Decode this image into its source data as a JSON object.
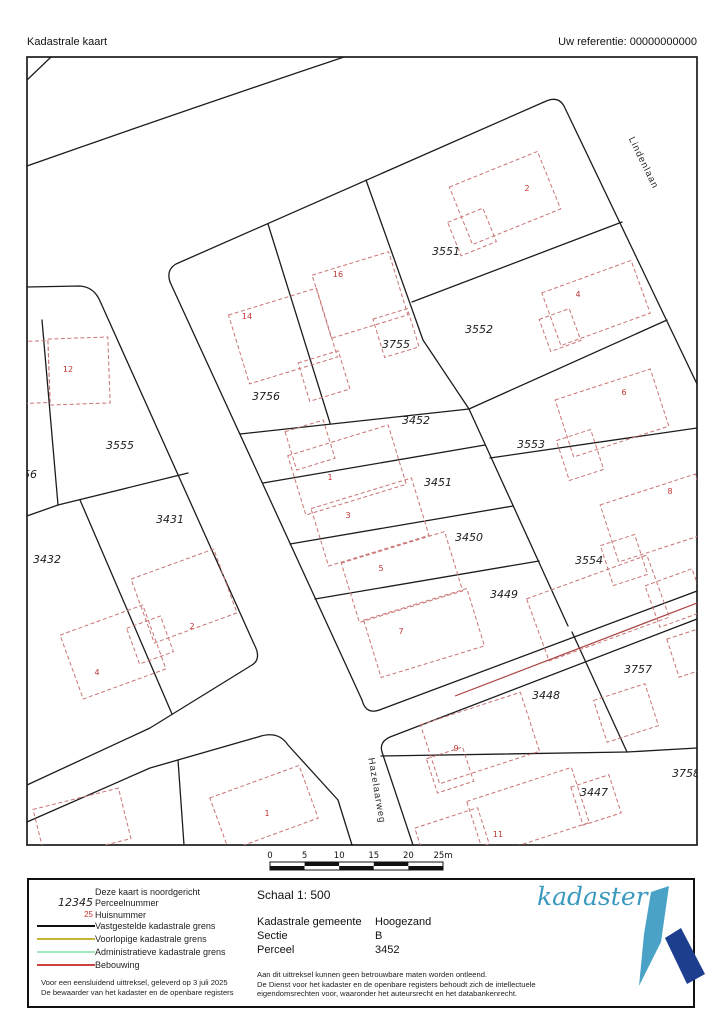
{
  "header": {
    "title": "Kadastrale kaart",
    "reference": "Uw referentie: 00000000000"
  },
  "map": {
    "streets": [
      {
        "name": "Lindenlaan",
        "x": 641,
        "y": 164,
        "rot": 64
      },
      {
        "name": "Hazelaarweg",
        "x": 374,
        "y": 791,
        "rot": 80
      }
    ],
    "parcels": [
      {
        "number": "3555",
        "x": 120,
        "y": 449
      },
      {
        "number": "56",
        "x": 30,
        "y": 478
      },
      {
        "number": "3431",
        "x": 170,
        "y": 523
      },
      {
        "number": "3432",
        "x": 47,
        "y": 563
      },
      {
        "number": "3756",
        "x": 266,
        "y": 400
      },
      {
        "number": "3755",
        "x": 396,
        "y": 348
      },
      {
        "number": "3551",
        "x": 446,
        "y": 255
      },
      {
        "number": "3552",
        "x": 479,
        "y": 333
      },
      {
        "number": "3452",
        "x": 416,
        "y": 424
      },
      {
        "number": "3451",
        "x": 438,
        "y": 486
      },
      {
        "number": "3450",
        "x": 469,
        "y": 541
      },
      {
        "number": "3449",
        "x": 504,
        "y": 598
      },
      {
        "number": "3553",
        "x": 531,
        "y": 448
      },
      {
        "number": "3554",
        "x": 589,
        "y": 564
      },
      {
        "number": "3757",
        "x": 638,
        "y": 673
      },
      {
        "number": "3758",
        "x": 686,
        "y": 777
      },
      {
        "number": "3448",
        "x": 546,
        "y": 699
      },
      {
        "number": "3447",
        "x": 594,
        "y": 796
      }
    ],
    "houses": [
      {
        "number": "10",
        "x": 21,
        "y": 376
      },
      {
        "number": "12",
        "x": 68,
        "y": 372
      },
      {
        "number": "14",
        "x": 247,
        "y": 319
      },
      {
        "number": "16",
        "x": 338,
        "y": 277
      },
      {
        "number": "2",
        "x": 527,
        "y": 191
      },
      {
        "number": "4",
        "x": 578,
        "y": 297
      },
      {
        "number": "6",
        "x": 624,
        "y": 395
      },
      {
        "number": "8",
        "x": 670,
        "y": 494
      },
      {
        "number": "1",
        "x": 330,
        "y": 480
      },
      {
        "number": "3",
        "x": 348,
        "y": 518
      },
      {
        "number": "5",
        "x": 381,
        "y": 571
      },
      {
        "number": "7",
        "x": 401,
        "y": 634
      },
      {
        "number": "9",
        "x": 456,
        "y": 751
      },
      {
        "number": "11",
        "x": 498,
        "y": 837
      },
      {
        "number": "2",
        "x": 192,
        "y": 629
      },
      {
        "number": "4",
        "x": 97,
        "y": 675
      },
      {
        "number": "1",
        "x": 267,
        "y": 816
      }
    ],
    "buildings": [
      {
        "cx": 36,
        "cy": 372,
        "w": 26,
        "h": 62,
        "a": -2
      },
      {
        "cx": 79,
        "cy": 371,
        "w": 60,
        "h": 66,
        "a": -2
      },
      {
        "cx": 283,
        "cy": 336,
        "w": 92,
        "h": 72,
        "a": -17
      },
      {
        "cx": 324,
        "cy": 376,
        "w": 42,
        "h": 40,
        "a": -17
      },
      {
        "cx": 360,
        "cy": 295,
        "w": 80,
        "h": 66,
        "a": -17
      },
      {
        "cx": 396,
        "cy": 333,
        "w": 36,
        "h": 40,
        "a": -17
      },
      {
        "cx": 505,
        "cy": 198,
        "w": 95,
        "h": 62,
        "a": -22
      },
      {
        "cx": 472,
        "cy": 232,
        "w": 38,
        "h": 36,
        "a": -22
      },
      {
        "cx": 596,
        "cy": 303,
        "w": 95,
        "h": 56,
        "a": -20
      },
      {
        "cx": 560,
        "cy": 330,
        "w": 32,
        "h": 34,
        "a": -20
      },
      {
        "cx": 612,
        "cy": 413,
        "w": 100,
        "h": 60,
        "a": -18
      },
      {
        "cx": 580,
        "cy": 455,
        "w": 36,
        "h": 42,
        "a": -18
      },
      {
        "cx": 657,
        "cy": 518,
        "w": 100,
        "h": 60,
        "a": -18
      },
      {
        "cx": 624,
        "cy": 560,
        "w": 36,
        "h": 42,
        "a": -18
      },
      {
        "cx": 347,
        "cy": 470,
        "w": 105,
        "h": 62,
        "a": -17
      },
      {
        "cx": 310,
        "cy": 445,
        "w": 40,
        "h": 40,
        "a": -17
      },
      {
        "cx": 370,
        "cy": 522,
        "w": 105,
        "h": 60,
        "a": -17
      },
      {
        "cx": 402,
        "cy": 577,
        "w": 108,
        "h": 62,
        "a": -17
      },
      {
        "cx": 424,
        "cy": 633,
        "w": 108,
        "h": 60,
        "a": -17
      },
      {
        "cx": 480,
        "cy": 738,
        "w": 105,
        "h": 62,
        "a": -18
      },
      {
        "cx": 450,
        "cy": 770,
        "w": 38,
        "h": 36,
        "a": -18
      },
      {
        "cx": 528,
        "cy": 812,
        "w": 110,
        "h": 58,
        "a": -18
      },
      {
        "cx": 596,
        "cy": 800,
        "w": 40,
        "h": 40,
        "a": -18
      },
      {
        "cx": 184,
        "cy": 596,
        "w": 88,
        "h": 68,
        "a": -20
      },
      {
        "cx": 150,
        "cy": 640,
        "w": 36,
        "h": 38,
        "a": -20
      },
      {
        "cx": 113,
        "cy": 652,
        "w": 88,
        "h": 68,
        "a": -20
      },
      {
        "cx": 264,
        "cy": 808,
        "w": 95,
        "h": 56,
        "a": -20
      },
      {
        "cx": 82,
        "cy": 824,
        "w": 88,
        "h": 52,
        "a": -14
      },
      {
        "cx": 598,
        "cy": 608,
        "w": 128,
        "h": 66,
        "a": -20
      },
      {
        "cx": 676,
        "cy": 598,
        "w": 50,
        "h": 44,
        "a": -20
      },
      {
        "cx": 626,
        "cy": 713,
        "w": 54,
        "h": 44,
        "a": -18
      },
      {
        "cx": 692,
        "cy": 652,
        "w": 40,
        "h": 40,
        "a": -18
      },
      {
        "cx": 452,
        "cy": 836,
        "w": 66,
        "h": 38,
        "a": -18
      }
    ],
    "colors": {
      "parcel_line": "#1c1c1c",
      "building_outline": "#c97474",
      "house_number": "#c23434",
      "bebouwing_line": "#a83e3e"
    }
  },
  "scalebar": {
    "ticks": [
      "0",
      "5",
      "10",
      "15",
      "20",
      "25m"
    ],
    "x0": 270,
    "x1": 443,
    "y_labels": 858,
    "y_bar": 862
  },
  "legend": {
    "north_note": "Deze kaart is noordgericht",
    "items": [
      {
        "type": "num",
        "symbol": "12345",
        "label": "Perceelnummer"
      },
      {
        "type": "red",
        "symbol": "25",
        "label": "Huisnummer"
      },
      {
        "type": "line",
        "color": "#111111",
        "label": "Vastgestelde kadastrale grens"
      },
      {
        "type": "line",
        "color": "#c9b43a",
        "label": "Voorlopige kadastrale grens"
      },
      {
        "type": "line",
        "color": "#9fe8c0",
        "label": "Administratieve kadastrale grens"
      },
      {
        "type": "line",
        "color": "#d04040",
        "label": "Bebouwing"
      }
    ],
    "footer_lines": [
      "Voor een eensluidend uittreksel, geleverd op 3 juli 2025",
      "De bewaarder van het kadaster en de openbare registers"
    ],
    "scale_label": "Schaal 1: 500",
    "details": [
      {
        "key": "Kadastrale gemeente",
        "value": "Hoogezand"
      },
      {
        "key": "Sectie",
        "value": "B"
      },
      {
        "key": "Perceel",
        "value": "3452"
      }
    ],
    "disclaimer_lines": [
      "Aan dit uittreksel kunnen geen betrouwbare maten worden ontleend.",
      "De Dienst voor het kadaster en de openbare registers behoudt zich de intellectuele",
      "eigendomsrechten voor, waaronder het auteursrecht en het databankenrecht."
    ],
    "logo_text": "kadaster",
    "logo_colors": {
      "light": "#4aa3c7",
      "dark": "#1d3d8f"
    }
  }
}
